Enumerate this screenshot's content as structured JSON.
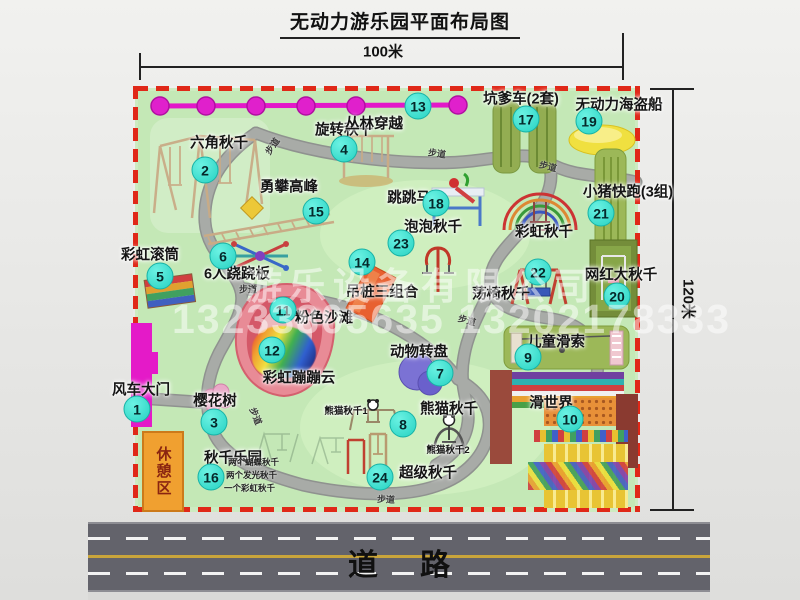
{
  "title": "无动力游乐园平面布局图",
  "dimensions": {
    "width": "100米",
    "height": "120米"
  },
  "watermark": {
    "company": "游乐设备有限公司",
    "phones": "13233805635 13202178333"
  },
  "road_label": "道路",
  "footpath_label": "步道",
  "rest_area_label": "休憩区",
  "extra_labels": {
    "rainbow_swing": "彩虹秋千",
    "panda_swing_1": "熊猫秋千1",
    "panda_swing_2": "熊猫秋千2"
  },
  "attractions": [
    {
      "num": "1",
      "label": "风车大门"
    },
    {
      "num": "2",
      "label": "六角秋千"
    },
    {
      "num": "3",
      "label": "樱花树"
    },
    {
      "num": "4",
      "label": "旋转秋千"
    },
    {
      "num": "5",
      "label": "彩虹滚筒"
    },
    {
      "num": "6",
      "label": "6人跷跷板"
    },
    {
      "num": "7",
      "label": "动物转盘"
    },
    {
      "num": "8",
      "label": "熊猫秋千"
    },
    {
      "num": "9",
      "label": "儿童滑索"
    },
    {
      "num": "10",
      "label": "滑世界"
    },
    {
      "num": "11",
      "label": "粉色沙滩"
    },
    {
      "num": "12",
      "label": "彩虹蹦蹦云"
    },
    {
      "num": "13",
      "label": "丛林穿越"
    },
    {
      "num": "14",
      "label": "吊桩三组合"
    },
    {
      "num": "15",
      "label": "勇攀高峰"
    },
    {
      "num": "16",
      "label": "秋千乐园",
      "sub_labels": [
        "两个蝴蝶秋千",
        "两个发光秋千",
        "一个彩虹秋千"
      ]
    },
    {
      "num": "17",
      "label": "坑爹车(2套)"
    },
    {
      "num": "18",
      "label": "跳跳马"
    },
    {
      "num": "19",
      "label": "无动力海盗船"
    },
    {
      "num": "20",
      "label": "网红大秋千"
    },
    {
      "num": "21",
      "label": "小猪快跑(3组)"
    },
    {
      "num": "22",
      "label": "荡椅秋千"
    },
    {
      "num": "23",
      "label": "泡泡秋千"
    },
    {
      "num": "24",
      "label": "超级秋千"
    }
  ],
  "colors": {
    "map_green": "#c4e8b6",
    "border_red": "#e02818",
    "badge_cyan": "#27d2c2",
    "zipline_magenta": "#e318c9",
    "gate_magenta": "#e41ac8",
    "rest_orange": "#f0a030",
    "road_gray": "#63636b"
  }
}
